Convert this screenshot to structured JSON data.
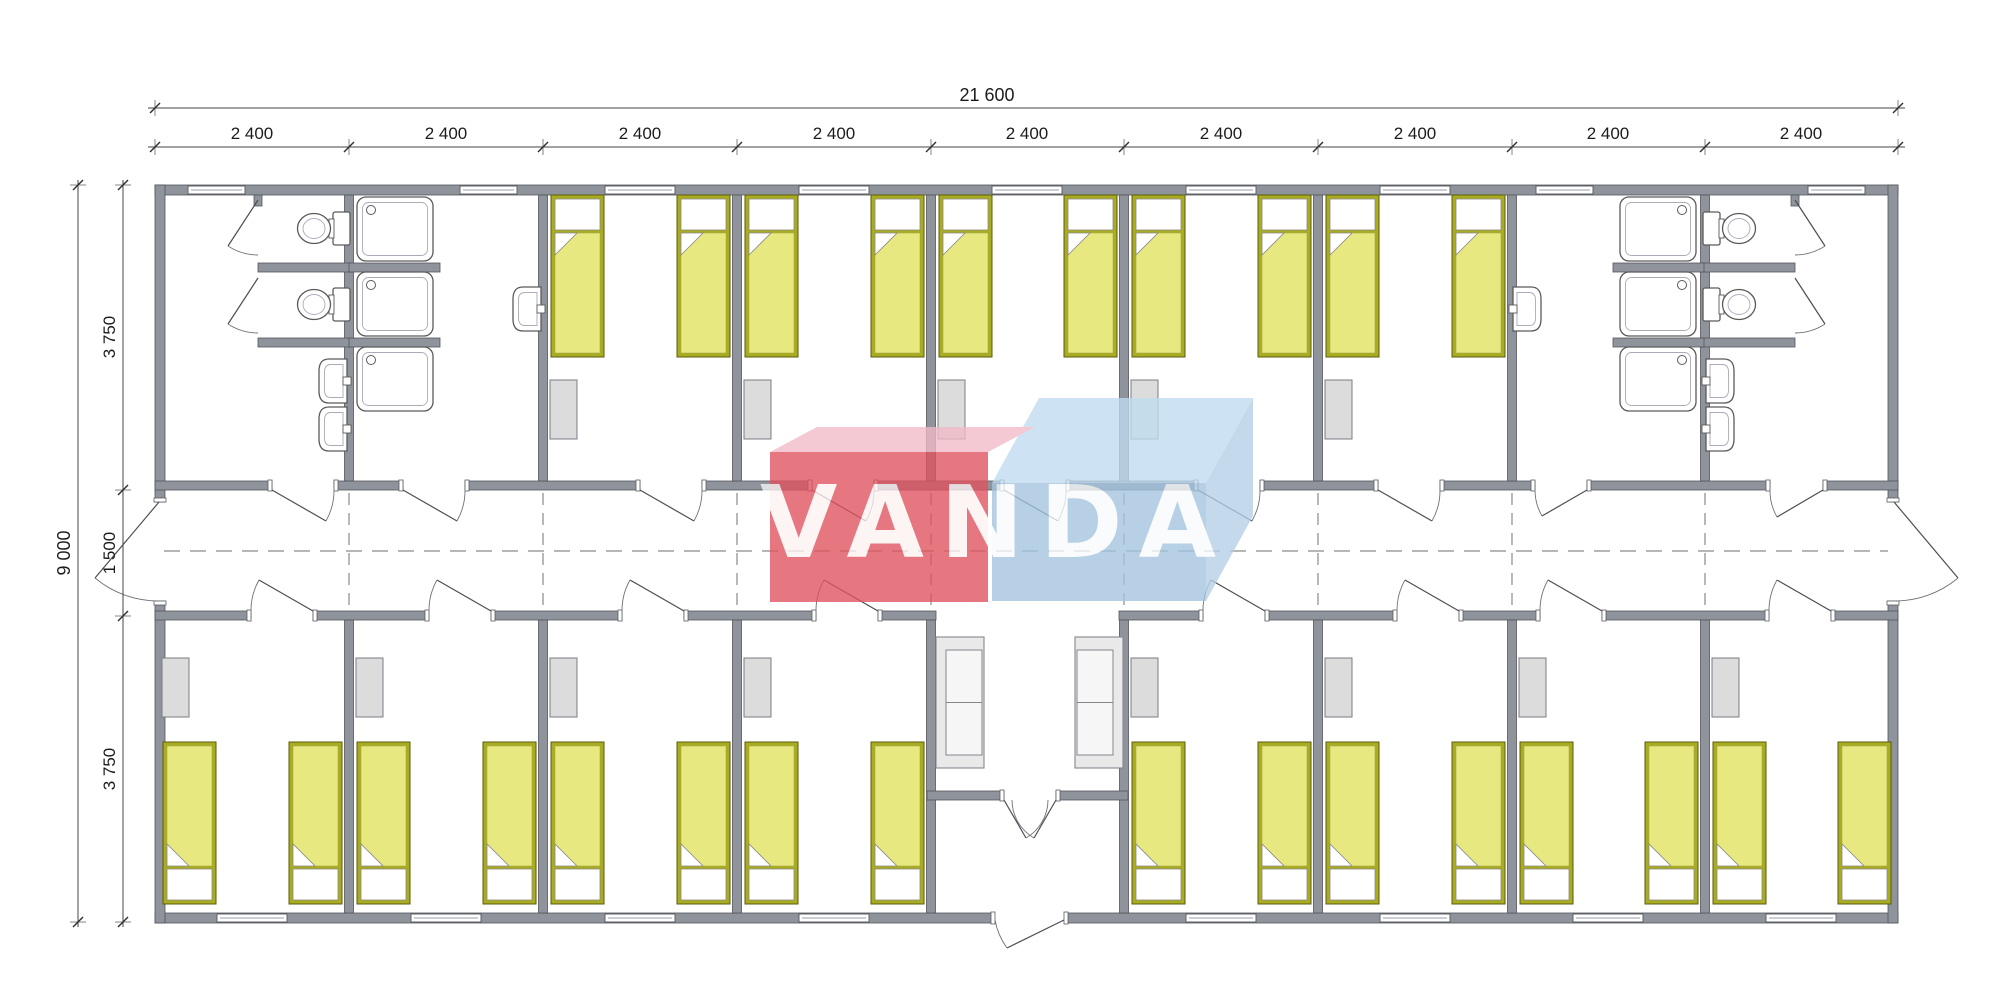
{
  "plan": {
    "type": "floor-plan",
    "dims": {
      "total_width": "21 600",
      "bay_width": "2 400",
      "bay_count": 9,
      "total_height": "9 000",
      "room_depth_top": "3 750",
      "corridor_width": "1 500",
      "room_depth_bottom": "3 750"
    },
    "watermark": {
      "text": "VANDA",
      "red": "#e0525e",
      "pink_top": "#f2bac7",
      "blue_front": "#a3c4df",
      "blue_top": "#bfdcf0",
      "blue_side": "#b4cfe6",
      "letters": "#ffffff"
    },
    "colors": {
      "wall": "#8f939b",
      "wall_outline": "#54565c",
      "bed_frame": "#a9ab20",
      "bed_frame_outline": "#5c5e0e",
      "bed_fill": "#e7e87f",
      "pillow": "#ffffff",
      "locker": "#dcdcdc",
      "sofa": "#e9e9e9",
      "fixture_line": "#5a5a5a",
      "dash": "#8a8a8a",
      "dim_line": "#444444",
      "text": "#1c1c1c"
    },
    "inventory": {
      "bedrooms_top": 5,
      "bedrooms_bottom": 8,
      "beds": 26,
      "bathrooms": 2,
      "showers": 6,
      "toilets": 4,
      "wash_basins": 6,
      "sofas": 2,
      "lockers": 13
    }
  }
}
